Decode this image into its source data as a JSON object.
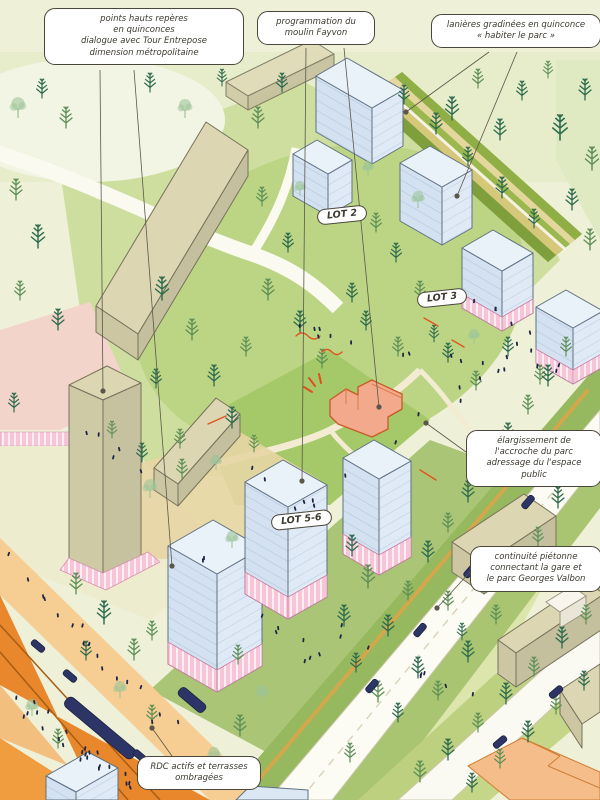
{
  "illustration": "axonometric masterplan of a park-side district",
  "annotations": {
    "points_hauts": [
      "points hauts repères",
      "en quinconces",
      "dialogue avec Tour Entrepose",
      "dimension métropolitaine"
    ],
    "moulin": [
      "programmation du",
      "moulin Fayvon"
    ],
    "lanieres": [
      "lanières gradinées en quinconce",
      "« habiter le parc »"
    ],
    "elargissement": [
      "élargissement de",
      "l'accroche du parc",
      "adressage du l'espace public"
    ],
    "continuite": [
      "continuité piétonne",
      "connectant la gare et",
      "le parc Georges Valbon"
    ],
    "rdc": [
      "RDC actifs et terrasses",
      "ombragées"
    ]
  },
  "lots": {
    "lot2": "LOT 2",
    "lot3": "LOT 3",
    "lot56": "LOT 5-6"
  },
  "palette": {
    "new_building_blue": "#dbe8f4",
    "plinth_pink": "#f7c5d8",
    "existing_beige": "#d8d3ae",
    "mill_orange": "#f3a98b",
    "road_orange": "#e8872b",
    "park_green": "#bcd584",
    "accent_red": "#e0551f",
    "vehicle_navy": "#2c3566"
  }
}
